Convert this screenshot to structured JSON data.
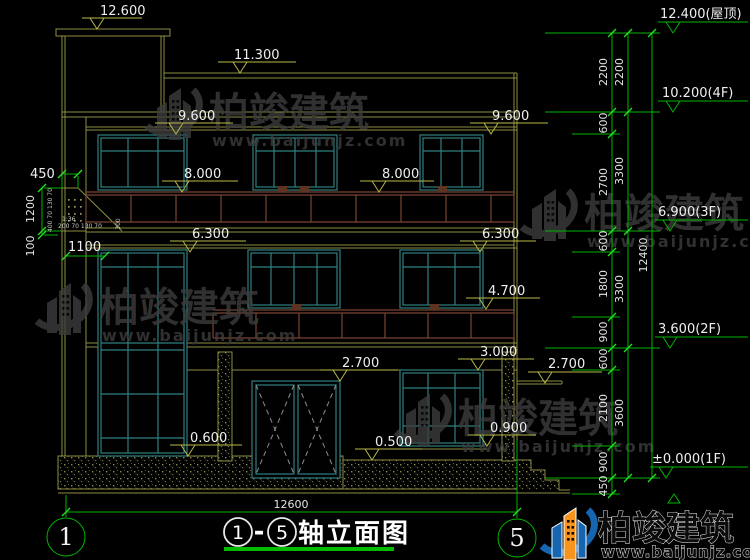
{
  "drawing": {
    "title": {
      "prefix_axis": "1",
      "separator": "-",
      "suffix_axis": "5",
      "label": "轴立面图"
    },
    "axes": {
      "start": "1",
      "end": "5"
    },
    "total_width_dim": "12600",
    "levels": {
      "roof": "12.400(屋顶)",
      "f4": "10.200(4F)",
      "f3": "6.900(3F)",
      "f2": "3.600(2F)",
      "f1": "±0.000(1F)"
    },
    "elevation_markers": {
      "tower_top": "12.600",
      "parapet": "11.300",
      "eave_left": "9.600",
      "eave_right": "9.600",
      "rail3f_left": "8.000",
      "rail3f_right": "8.000",
      "slab3f_left": "6.300",
      "slab3f_right": "6.300",
      "rail2f": "4.700",
      "beam1f": "3.000",
      "door_top": "2.700",
      "canopy": "2.700",
      "sill_1f": "0.900",
      "plinth_right": "0.500",
      "plinth_left": "0.600"
    },
    "dims_right_inner": [
      "2200",
      "600",
      "2700",
      "600",
      "1800",
      "900",
      "600",
      "2100",
      "900",
      "450"
    ],
    "dims_right_mid": [
      "2200",
      "3300",
      "3300",
      "3600"
    ],
    "dims_right_total": "12400",
    "dims_left": {
      "offset": "450",
      "height": "1200",
      "small": "100",
      "rail_height": "1100"
    },
    "detail_dims": {
      "slope": "1:36",
      "row1": "200 70 130 70",
      "col1": "400 70 130 70",
      "col2": "300"
    }
  },
  "watermark": {
    "brand": "柏竣建筑",
    "url": "www.baijunjz.com"
  },
  "colors": {
    "background": "#000000",
    "line_structure": "#8d8d42",
    "line_marker": "#b8b848",
    "line_dimension": "#00b400",
    "window_frame": "#2f7f7f",
    "railing": "#7a4530",
    "text": "#efefef",
    "watermark_gray": "#3c3c3c",
    "brand_blue": "#1565b0",
    "brand_orange": "#f7941d"
  }
}
